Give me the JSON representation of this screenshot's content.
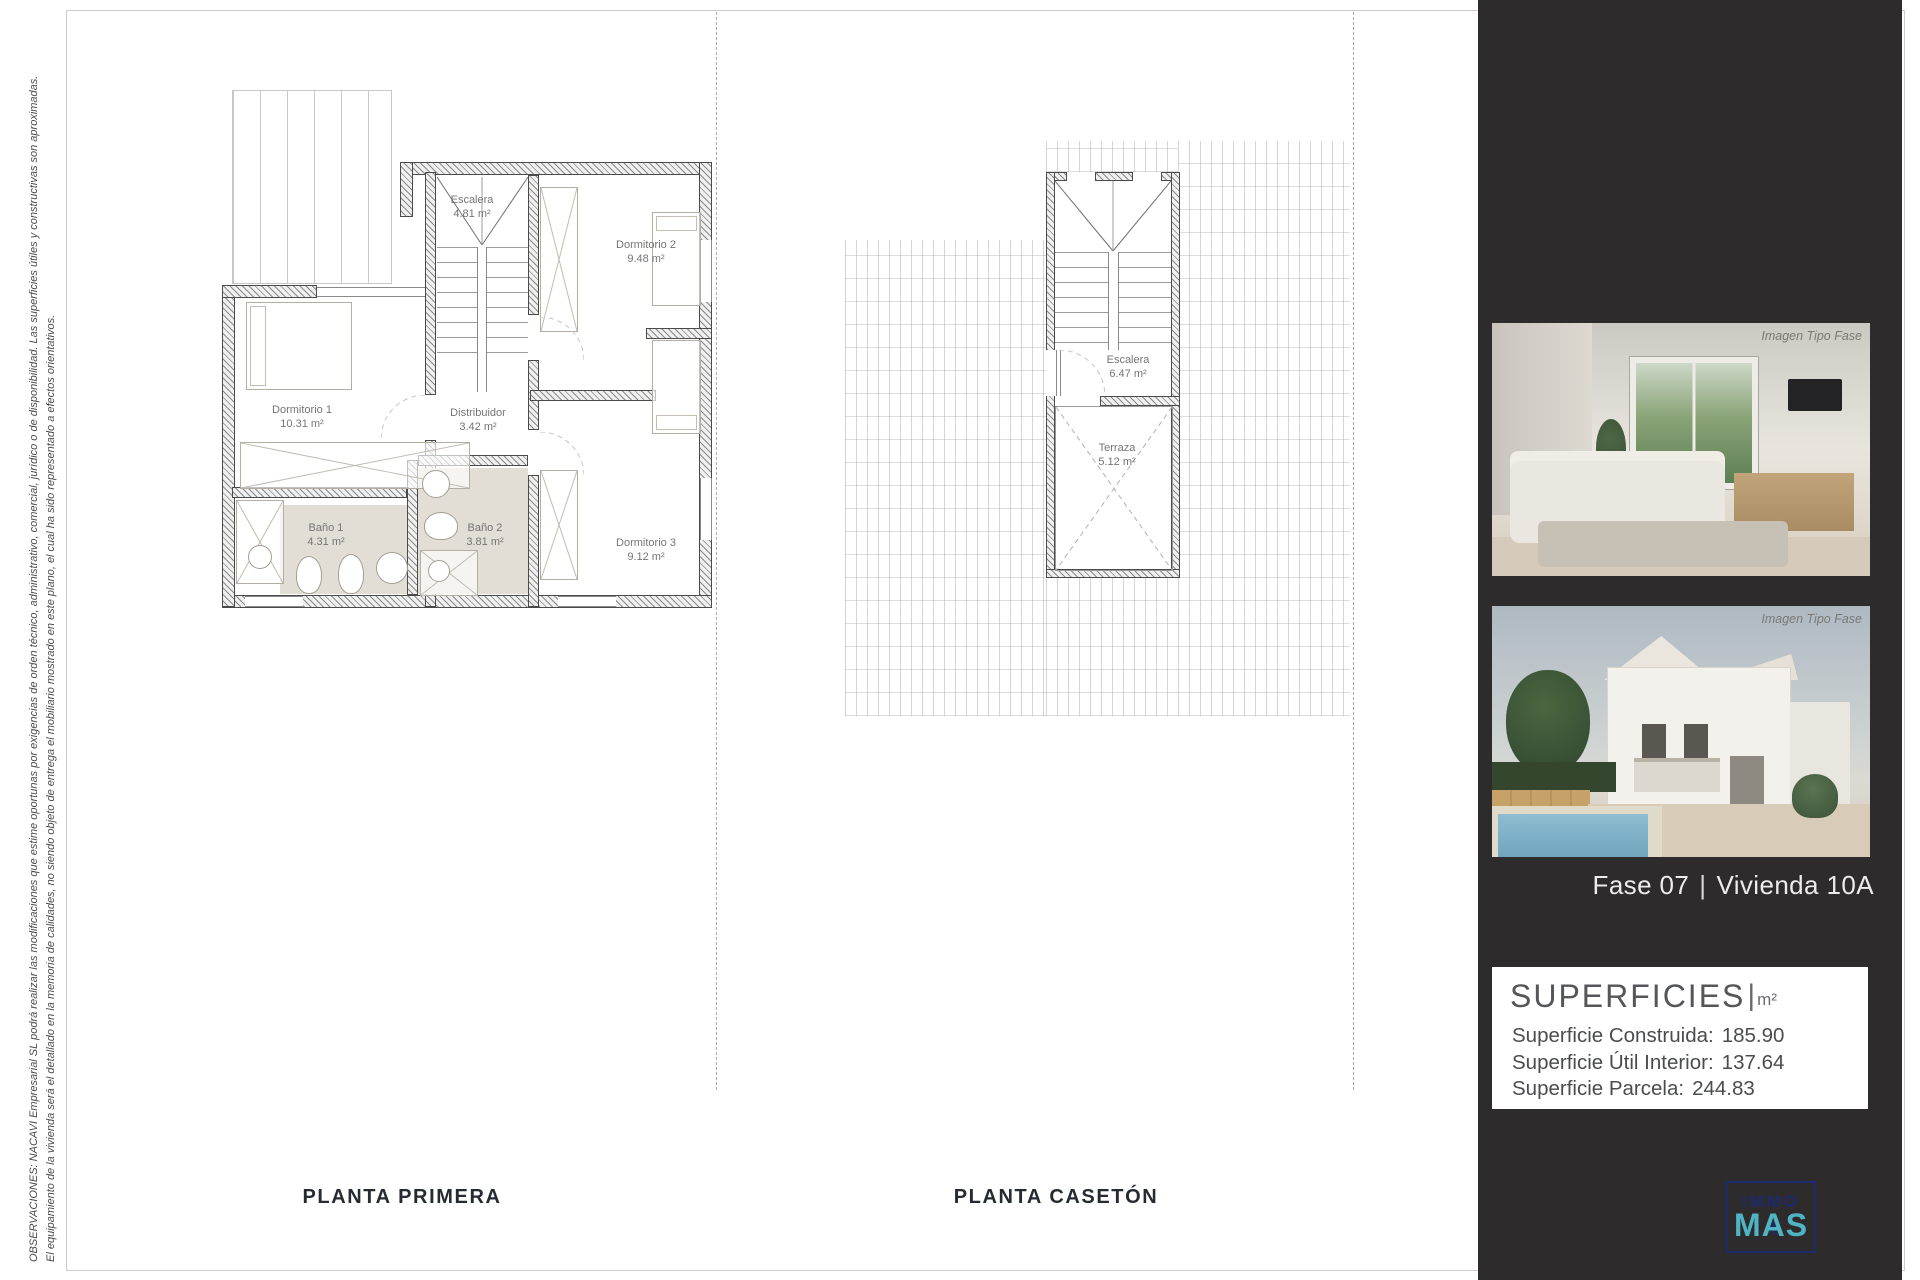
{
  "disclaimer": {
    "line1": "OBSERVACIONES: NACAVI Empresarial SL podrá realizar las modificaciones que estime oportunas por exigencias de orden técnico, administrativo, comercial, jurídico o de disponibilidad. Las superficies útiles y constructivas son aproximadas.",
    "line2": "El equipamiento de la vivienda será el detallado en la memoria de calidades, no siendo objeto de entrega el mobiliario mostrado en este  plano, el  cual ha sido representado a efectos orientativos."
  },
  "plans": [
    {
      "title": "PLANTA PRIMERA",
      "rooms": [
        {
          "name": "Escalera",
          "area": "4.81 m²"
        },
        {
          "name": "Dormitorio 2",
          "area": "9.48 m²"
        },
        {
          "name": "Dormitorio 1",
          "area": "10.31 m²"
        },
        {
          "name": "Distribuidor",
          "area": "3.42 m²"
        },
        {
          "name": "Baño 1",
          "area": "4.31 m²"
        },
        {
          "name": "Baño 2",
          "area": "3.81 m²"
        },
        {
          "name": "Dormitorio 3",
          "area": "9.12 m²"
        }
      ]
    },
    {
      "title": "PLANTA CASETÓN",
      "rooms": [
        {
          "name": "Escalera",
          "area": "6.47 m²"
        },
        {
          "name": "Terraza",
          "area": "5.12 m²"
        }
      ]
    }
  ],
  "sidebar": {
    "background": "#2e2b2c",
    "photo_caption": "Imagen Tipo Fase",
    "unit": {
      "phase": "Fase 07",
      "separator": "|",
      "name": "Vivienda 10A"
    },
    "superficies": {
      "title": "SUPERFICIES",
      "separator": "|",
      "unit": "m²",
      "rows": [
        {
          "label": "Superficie Construida:",
          "value": "185.90"
        },
        {
          "label": "Superficie Útil Interior:",
          "value": "137.64"
        },
        {
          "label": "Superficie Parcela:",
          "value": "244.83"
        }
      ]
    },
    "logo": {
      "line1": "IMMO",
      "line2": "MAS",
      "plus": "+",
      "navy": "#1c2a6e",
      "teal": "#4fb5c5"
    }
  }
}
